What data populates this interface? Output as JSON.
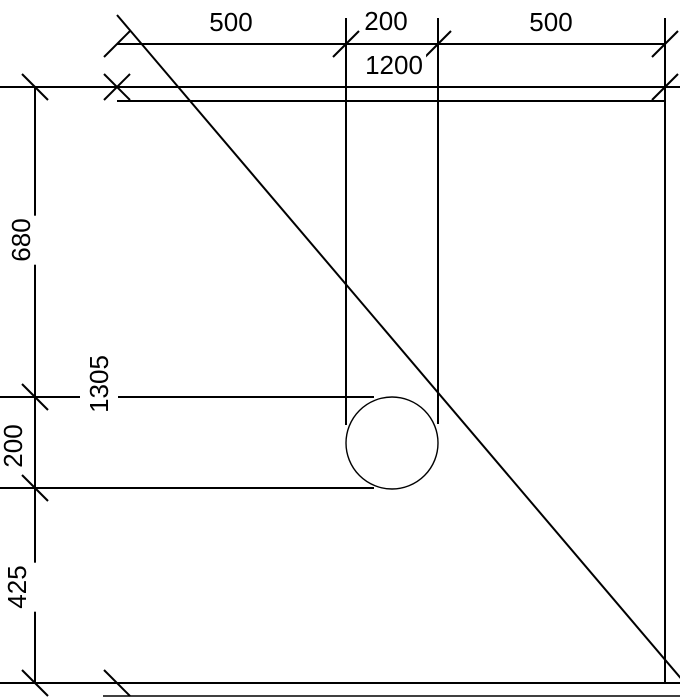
{
  "drawing": {
    "background_color": "#ffffff",
    "line_color": "#000000",
    "dim_top_segments": {
      "left": "500",
      "middle": "200",
      "right": "500"
    },
    "dim_top_overall": "1200",
    "dim_left_segments": {
      "top": "680",
      "middle": "200",
      "bottom": "425"
    },
    "dim_left_overall": "1305"
  }
}
